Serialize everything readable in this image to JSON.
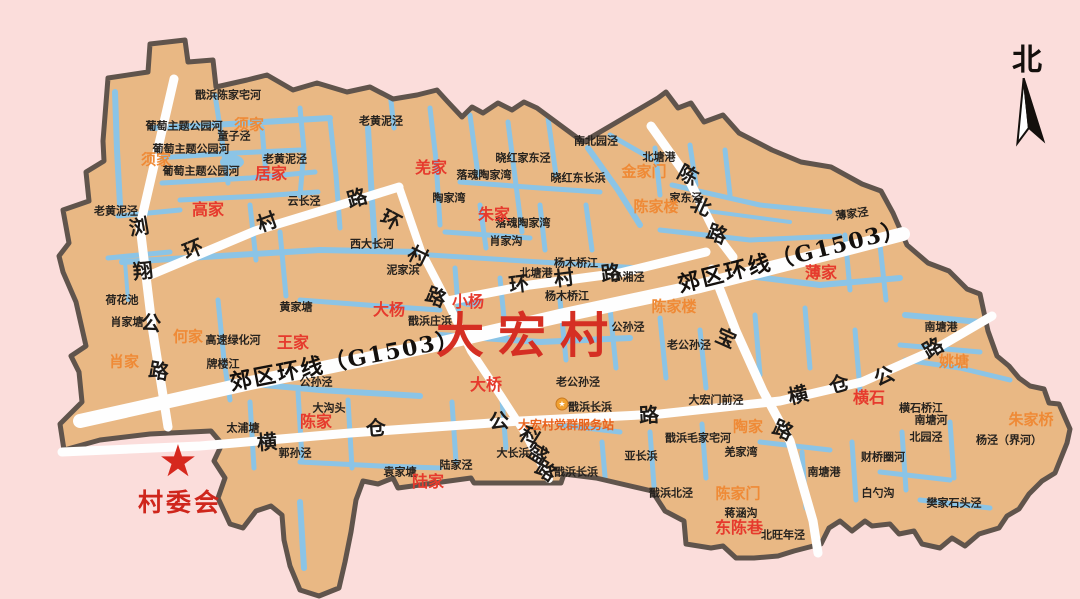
{
  "page": {
    "background": "#fbdddb"
  },
  "map": {
    "title": {
      "text": "大宏村",
      "x": 529,
      "y": 331
    },
    "north": {
      "label": "北",
      "x": 1027,
      "y": 57
    },
    "committee": {
      "label": "村委会",
      "x": 180,
      "y": 501,
      "star": "★",
      "star_x": 178,
      "star_y": 462
    },
    "service_station": {
      "label": "大宏村党群服务站",
      "x": 566,
      "y": 425,
      "icon": "★",
      "icon_x": 562,
      "icon_y": 404
    },
    "road_names": [
      "郊区环线（G1503）",
      "浏翔公路",
      "环村路",
      "陈北路",
      "横仓公路",
      "科盛路",
      "宝路"
    ],
    "colors": {
      "background": "#fbdddb",
      "land": "#e9b884",
      "water": "#8bc4e6",
      "border": "#60544c",
      "road": "#fefefe",
      "title_red": "#d52f23",
      "hamlet_red": "#e63a2d",
      "hamlet_orange": "#ef8a36",
      "poi_orange": "#e8611c"
    },
    "labels": [
      {
        "t": "戬浜陈家宅河",
        "x": 228,
        "y": 95,
        "c": "water"
      },
      {
        "t": "葡萄主题公园河",
        "x": 184,
        "y": 126,
        "c": "water"
      },
      {
        "t": "葡萄主题公园河",
        "x": 191,
        "y": 149,
        "c": "water"
      },
      {
        "t": "葡萄主题公园河",
        "x": 201,
        "y": 171,
        "c": "water"
      },
      {
        "t": "童子泾",
        "x": 234,
        "y": 136,
        "c": "water"
      },
      {
        "t": "老黄泥泾",
        "x": 381,
        "y": 121,
        "c": "water"
      },
      {
        "t": "老黄泥泾",
        "x": 285,
        "y": 159,
        "c": "water"
      },
      {
        "t": "老黄泥泾",
        "x": 116,
        "y": 211,
        "c": "water"
      },
      {
        "t": "云长泾",
        "x": 304,
        "y": 201,
        "c": "water"
      },
      {
        "t": "西大长河",
        "x": 372,
        "y": 244,
        "c": "water"
      },
      {
        "t": "泥家浜",
        "x": 403,
        "y": 270,
        "c": "water"
      },
      {
        "t": "荷花池",
        "x": 122,
        "y": 300,
        "c": "water"
      },
      {
        "t": "肖家塘",
        "x": 127,
        "y": 322,
        "c": "water"
      },
      {
        "t": "高速绿化河",
        "x": 233,
        "y": 340,
        "c": "water"
      },
      {
        "t": "牌楼江",
        "x": 223,
        "y": 364,
        "c": "water"
      },
      {
        "t": "黄家塘",
        "x": 296,
        "y": 307,
        "c": "water"
      },
      {
        "t": "晓红家东泾",
        "x": 523,
        "y": 158,
        "c": "water"
      },
      {
        "t": "晓红东长浜",
        "x": 578,
        "y": 178,
        "c": "water"
      },
      {
        "t": "南北园泾",
        "x": 596,
        "y": 141,
        "c": "water"
      },
      {
        "t": "北塘港",
        "x": 659,
        "y": 157,
        "c": "water"
      },
      {
        "t": "家东泾",
        "x": 686,
        "y": 198,
        "c": "water"
      },
      {
        "t": "薄家泾",
        "x": 852,
        "y": 214,
        "c": "water",
        "r": -8
      },
      {
        "t": "落魂陶家湾",
        "x": 484,
        "y": 175,
        "c": "water"
      },
      {
        "t": "落魂陶家湾",
        "x": 523,
        "y": 223,
        "c": "water"
      },
      {
        "t": "陶家湾",
        "x": 449,
        "y": 198,
        "c": "water"
      },
      {
        "t": "肖家沟",
        "x": 506,
        "y": 241,
        "c": "water"
      },
      {
        "t": "杨木桥江",
        "x": 576,
        "y": 263,
        "c": "water"
      },
      {
        "t": "杨木桥江",
        "x": 567,
        "y": 296,
        "c": "water"
      },
      {
        "t": "北塘港",
        "x": 536,
        "y": 273,
        "c": "water"
      },
      {
        "t": "小湘泾",
        "x": 628,
        "y": 277,
        "c": "water"
      },
      {
        "t": "戬浜庄浜",
        "x": 430,
        "y": 321,
        "c": "water"
      },
      {
        "t": "公孙泾",
        "x": 316,
        "y": 382,
        "c": "water"
      },
      {
        "t": "公孙泾",
        "x": 628,
        "y": 327,
        "c": "water"
      },
      {
        "t": "老公孙泾",
        "x": 689,
        "y": 345,
        "c": "water"
      },
      {
        "t": "老公孙泾",
        "x": 578,
        "y": 382,
        "c": "water"
      },
      {
        "t": "大沟头",
        "x": 329,
        "y": 408,
        "c": "water"
      },
      {
        "t": "太浦塘",
        "x": 243,
        "y": 428,
        "c": "water"
      },
      {
        "t": "郭孙泾",
        "x": 295,
        "y": 453,
        "c": "water"
      },
      {
        "t": "袁家塘",
        "x": 400,
        "y": 472,
        "c": "water"
      },
      {
        "t": "陆家泾",
        "x": 456,
        "y": 465,
        "c": "water"
      },
      {
        "t": "大长浜",
        "x": 513,
        "y": 453,
        "c": "water"
      },
      {
        "t": "戬浜长浜",
        "x": 590,
        "y": 407,
        "c": "water"
      },
      {
        "t": "戬浜长浜",
        "x": 576,
        "y": 472,
        "c": "water"
      },
      {
        "t": "亚长浜",
        "x": 641,
        "y": 456,
        "c": "water"
      },
      {
        "t": "戬浜毛家宅河",
        "x": 698,
        "y": 438,
        "c": "water"
      },
      {
        "t": "羌家湾",
        "x": 741,
        "y": 452,
        "c": "water"
      },
      {
        "t": "戬浜北泾",
        "x": 671,
        "y": 493,
        "c": "water"
      },
      {
        "t": "蒋涵沟",
        "x": 741,
        "y": 513,
        "c": "water"
      },
      {
        "t": "北旺年泾",
        "x": 783,
        "y": 535,
        "c": "water"
      },
      {
        "t": "大宏门前泾",
        "x": 716,
        "y": 400,
        "c": "water"
      },
      {
        "t": "南塘港",
        "x": 941,
        "y": 327,
        "c": "water"
      },
      {
        "t": "南塘港",
        "x": 824,
        "y": 472,
        "c": "water"
      },
      {
        "t": "南塘河",
        "x": 931,
        "y": 420,
        "c": "water"
      },
      {
        "t": "横石桥江",
        "x": 921,
        "y": 408,
        "c": "water"
      },
      {
        "t": "北园泾",
        "x": 926,
        "y": 437,
        "c": "water"
      },
      {
        "t": "财桥圈河",
        "x": 883,
        "y": 457,
        "c": "water"
      },
      {
        "t": "白勺沟",
        "x": 878,
        "y": 493,
        "c": "water"
      },
      {
        "t": "樊家石头泾",
        "x": 954,
        "y": 503,
        "c": "water"
      },
      {
        "t": "杨泾（界河）",
        "x": 1009,
        "y": 440,
        "c": "water"
      },
      {
        "t": "高家",
        "x": 208,
        "y": 210,
        "c": "red"
      },
      {
        "t": "居家",
        "x": 271,
        "y": 174,
        "c": "red"
      },
      {
        "t": "羌家",
        "x": 431,
        "y": 168,
        "c": "red"
      },
      {
        "t": "朱家",
        "x": 494,
        "y": 215,
        "c": "red"
      },
      {
        "t": "大杨",
        "x": 389,
        "y": 310,
        "c": "red"
      },
      {
        "t": "小杨",
        "x": 468,
        "y": 302,
        "c": "red"
      },
      {
        "t": "王家",
        "x": 293,
        "y": 343,
        "c": "red"
      },
      {
        "t": "大桥",
        "x": 486,
        "y": 385,
        "c": "red"
      },
      {
        "t": "陈家",
        "x": 316,
        "y": 422,
        "c": "red"
      },
      {
        "t": "陆家",
        "x": 428,
        "y": 482,
        "c": "red"
      },
      {
        "t": "薄家",
        "x": 821,
        "y": 273,
        "c": "red"
      },
      {
        "t": "横石",
        "x": 869,
        "y": 398,
        "c": "red"
      },
      {
        "t": "东陈巷",
        "x": 739,
        "y": 528,
        "c": "red"
      },
      {
        "t": "须家",
        "x": 156,
        "y": 160,
        "c": "orange"
      },
      {
        "t": "须家",
        "x": 249,
        "y": 125,
        "c": "orange"
      },
      {
        "t": "何家",
        "x": 188,
        "y": 337,
        "c": "orange"
      },
      {
        "t": "肖家",
        "x": 124,
        "y": 362,
        "c": "orange"
      },
      {
        "t": "金家门",
        "x": 644,
        "y": 172,
        "c": "orange"
      },
      {
        "t": "陈家楼",
        "x": 656,
        "y": 207,
        "c": "orange"
      },
      {
        "t": "陈家楼",
        "x": 674,
        "y": 307,
        "c": "orange"
      },
      {
        "t": "陶家",
        "x": 748,
        "y": 427,
        "c": "orange"
      },
      {
        "t": "姚塘",
        "x": 954,
        "y": 362,
        "c": "orange"
      },
      {
        "t": "朱家桥",
        "x": 1031,
        "y": 420,
        "c": "orange"
      },
      {
        "t": "陈家门",
        "x": 738,
        "y": 494,
        "c": "orange"
      },
      {
        "t": "浏",
        "x": 139,
        "y": 227,
        "c": "road",
        "r": -10
      },
      {
        "t": "翔",
        "x": 143,
        "y": 271,
        "c": "road",
        "r": -6
      },
      {
        "t": "公",
        "x": 151,
        "y": 323,
        "c": "road",
        "r": 6
      },
      {
        "t": "路",
        "x": 159,
        "y": 371,
        "c": "road",
        "r": 10
      },
      {
        "t": "环",
        "x": 193,
        "y": 249,
        "c": "road",
        "r": -22
      },
      {
        "t": "村",
        "x": 267,
        "y": 222,
        "c": "road",
        "r": -20
      },
      {
        "t": "路",
        "x": 357,
        "y": 198,
        "c": "road",
        "r": -16
      },
      {
        "t": "环",
        "x": 391,
        "y": 220,
        "c": "road",
        "r": 28
      },
      {
        "t": "村",
        "x": 418,
        "y": 256,
        "c": "road",
        "r": 26
      },
      {
        "t": "路",
        "x": 436,
        "y": 297,
        "c": "road",
        "r": 22
      },
      {
        "t": "环",
        "x": 519,
        "y": 284,
        "c": "road",
        "r": -7
      },
      {
        "t": "村",
        "x": 564,
        "y": 278,
        "c": "road",
        "r": -7
      },
      {
        "t": "路",
        "x": 611,
        "y": 273,
        "c": "road",
        "r": -7
      },
      {
        "t": "陈",
        "x": 688,
        "y": 175,
        "c": "road",
        "r": 28
      },
      {
        "t": "北",
        "x": 701,
        "y": 206,
        "c": "road",
        "r": 24
      },
      {
        "t": "路",
        "x": 717,
        "y": 234,
        "c": "road",
        "r": 20
      },
      {
        "t": "宝",
        "x": 726,
        "y": 338,
        "c": "road",
        "r": 24
      },
      {
        "t": "路",
        "x": 783,
        "y": 430,
        "c": "road",
        "r": 24
      },
      {
        "t": "横",
        "x": 267,
        "y": 442,
        "c": "road",
        "r": -5
      },
      {
        "t": "仓",
        "x": 376,
        "y": 428,
        "c": "road",
        "r": -5
      },
      {
        "t": "公",
        "x": 499,
        "y": 421,
        "c": "road",
        "r": -4
      },
      {
        "t": "路",
        "x": 649,
        "y": 415,
        "c": "road",
        "r": -3
      },
      {
        "t": "横",
        "x": 798,
        "y": 395,
        "c": "road",
        "r": -14
      },
      {
        "t": "仓",
        "x": 839,
        "y": 384,
        "c": "road",
        "r": -16
      },
      {
        "t": "公",
        "x": 884,
        "y": 376,
        "c": "road",
        "r": -22
      },
      {
        "t": "路",
        "x": 933,
        "y": 348,
        "c": "road",
        "r": -30
      },
      {
        "t": "科",
        "x": 530,
        "y": 437,
        "c": "road",
        "r": 32
      },
      {
        "t": "盛",
        "x": 538,
        "y": 454,
        "c": "road",
        "r": 32
      },
      {
        "t": "路",
        "x": 546,
        "y": 471,
        "c": "road",
        "r": 32
      },
      {
        "t": "郊区环线（G1503）",
        "x": 345,
        "y": 361,
        "c": "roadbig",
        "r": -11
      },
      {
        "t": "郊区环线（G1503）",
        "x": 792,
        "y": 257,
        "c": "roadbig",
        "r": -14
      }
    ]
  }
}
